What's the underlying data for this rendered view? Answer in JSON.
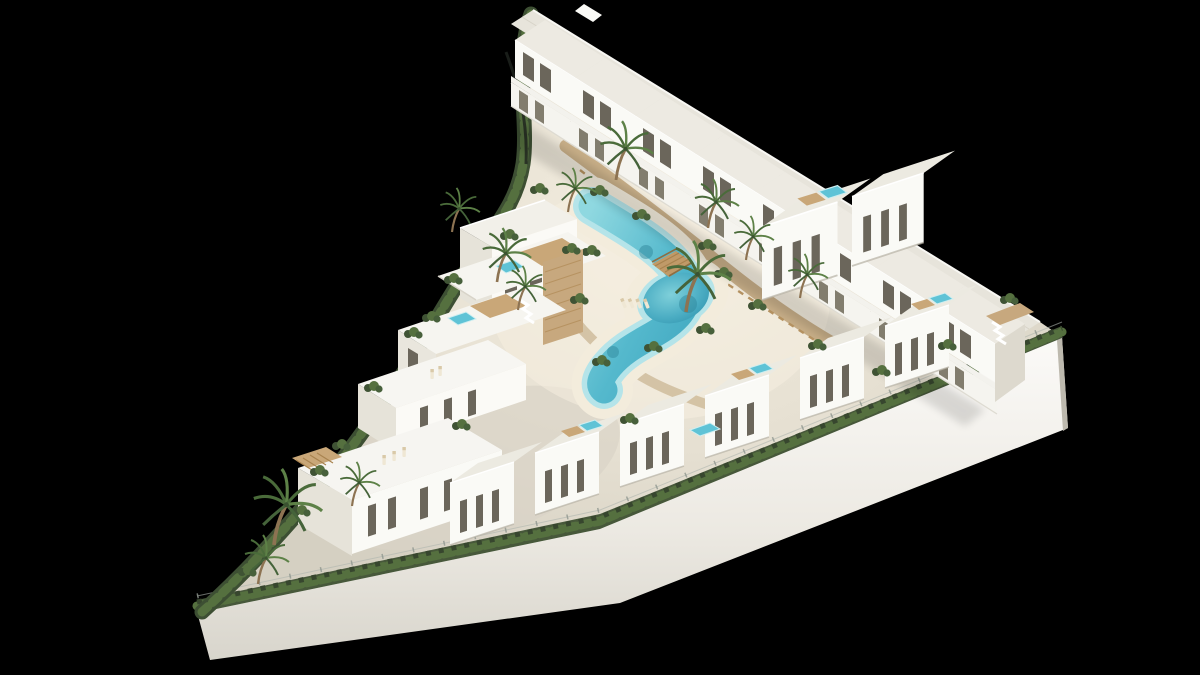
{
  "scene": {
    "title": "Aerial 3D render of a coastal residential development",
    "alt_text": "Bird's-eye 3D architectural rendering of a white Mediterranean residential complex on a triangular hillside plot, isolated on a black background. A turquoise lagoon-style pool with a sandy beach edge and a wooden footbridge winds through the centre, surrounded by palm trees and tropical planting. A long row of white flat-roofed townhouses steps down the upper-right edge, stepped apartment blocks with roof terraces, timber decks and plunge jacuzzis occupy the left side, and a row of villas with tall narrow windows lines the lower retaining wall, which is topped by a continuous green hedge and wire fence."
  },
  "palette": {
    "background": "#000000",
    "facade_white": "#fafaf6",
    "facade_shadow": "#dfdcd2",
    "roof_light": "#edeae2",
    "perimeter_wall": "#e9e6df",
    "window_glass": "#6b665b",
    "timber_deck": "#c9a778",
    "stone_cladding": "#c7a87e",
    "pool_water": "#3fa6bf",
    "pool_shallow": "#8fd8e0",
    "beach_sand": "#f3ecdc",
    "pathway_tan": "#c3a87f",
    "hedge_green": "#3d4f33",
    "palm_green": "#4a6b3a"
  },
  "site": {
    "plot_shape": "triangular",
    "boundary": {
      "retaining_wall": "white retaining wall along the lower edge",
      "hedge_fence": "continuous hedge with wire fence on top of the wall",
      "west_edge": "curved landscaped hedge border"
    },
    "amenities": {
      "lagoon_pool": "winding lagoon pool with sandy beach shore",
      "footbridge": "arched wooden footbridge over the pool",
      "sun_loungers": "loungers on the beach and roof decks",
      "landscaping": "palm trees and tropical shrubs"
    },
    "buildings": {
      "top_row_townhouses": {
        "count": 8,
        "features": [
          "flat roofs",
          "balconies",
          "dark recessed windows"
        ]
      },
      "right_mid_houses": {
        "count": 2,
        "features": [
          "two storeys",
          "terraces"
        ]
      },
      "bottom_row_villas": {
        "count": 6,
        "features": [
          "tall narrow windows",
          "roof decks",
          "plunge pools"
        ]
      },
      "left_terrace_blocks": {
        "count": 4,
        "features": [
          "stepped roof terraces",
          "timber decks",
          "jacuzzis",
          "stone-clad cores"
        ]
      }
    },
    "palm_tree_count": 12
  }
}
